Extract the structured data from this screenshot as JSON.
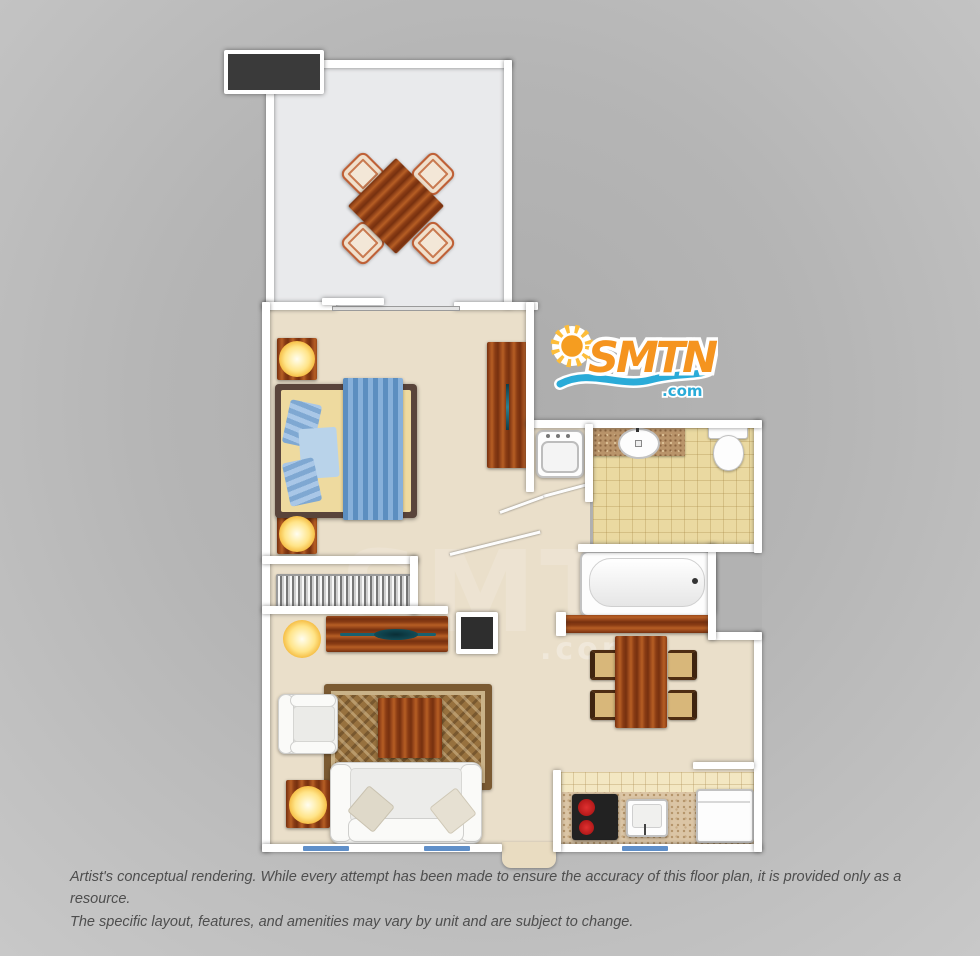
{
  "canvas": {
    "width": 980,
    "height": 956,
    "background_gray": "#b3b3b3"
  },
  "logo": {
    "text": "SMTN",
    "tld": ".com",
    "orange": "#f5941f",
    "blue": "#2aabd8",
    "sun_ray_color": "#fdbd3a"
  },
  "watermark": {
    "text": "SMTN",
    "tld": ".com"
  },
  "disclaimer": {
    "line1": "Artist's conceptual rendering. While every attempt has been made to ensure the accuracy of this floor plan, it is provided only as a resource.",
    "line2": "The specific layout, features, and amenities may vary by unit and are subject to change."
  },
  "floorplan": {
    "wall_color": "#ffffff",
    "window_color": "#5f8fc9",
    "wood_color": "#a04d1d",
    "rooms": [
      {
        "name": "balcony",
        "floor_color": "#e9eaec",
        "furniture": [
          "patio-table",
          "patio-chair (x4)",
          "ac-unit"
        ]
      },
      {
        "name": "bedroom",
        "floor_color": "#eadfca",
        "furniture": [
          "bed",
          "bed-runner",
          "pillows",
          "nightstand (x2)",
          "table-lamp (x2)",
          "dresser",
          "accordion-closet",
          "sliding-glass-door"
        ]
      },
      {
        "name": "bathroom",
        "floor_color": "#ead9a1",
        "furniture": [
          "vanity-counter",
          "sink",
          "toilet",
          "bathtub",
          "washer"
        ]
      },
      {
        "name": "living-room",
        "floor_color": "#eadfca",
        "furniture": [
          "tv-console",
          "tv",
          "floor-lamp",
          "entry-closet-box",
          "area-rug",
          "coffee-table",
          "armchair",
          "sofa",
          "sofa-pillows",
          "end-table",
          "table-lamp"
        ]
      },
      {
        "name": "dining-area",
        "floor_color": "#eadfca",
        "furniture": [
          "dining-table",
          "dining-chair (x4)",
          "breakfast-bar"
        ]
      },
      {
        "name": "kitchen",
        "floor_color": "#f3e7c2",
        "furniture": [
          "stove",
          "burners",
          "kitchen-sink",
          "refrigerator",
          "counter"
        ]
      }
    ]
  }
}
